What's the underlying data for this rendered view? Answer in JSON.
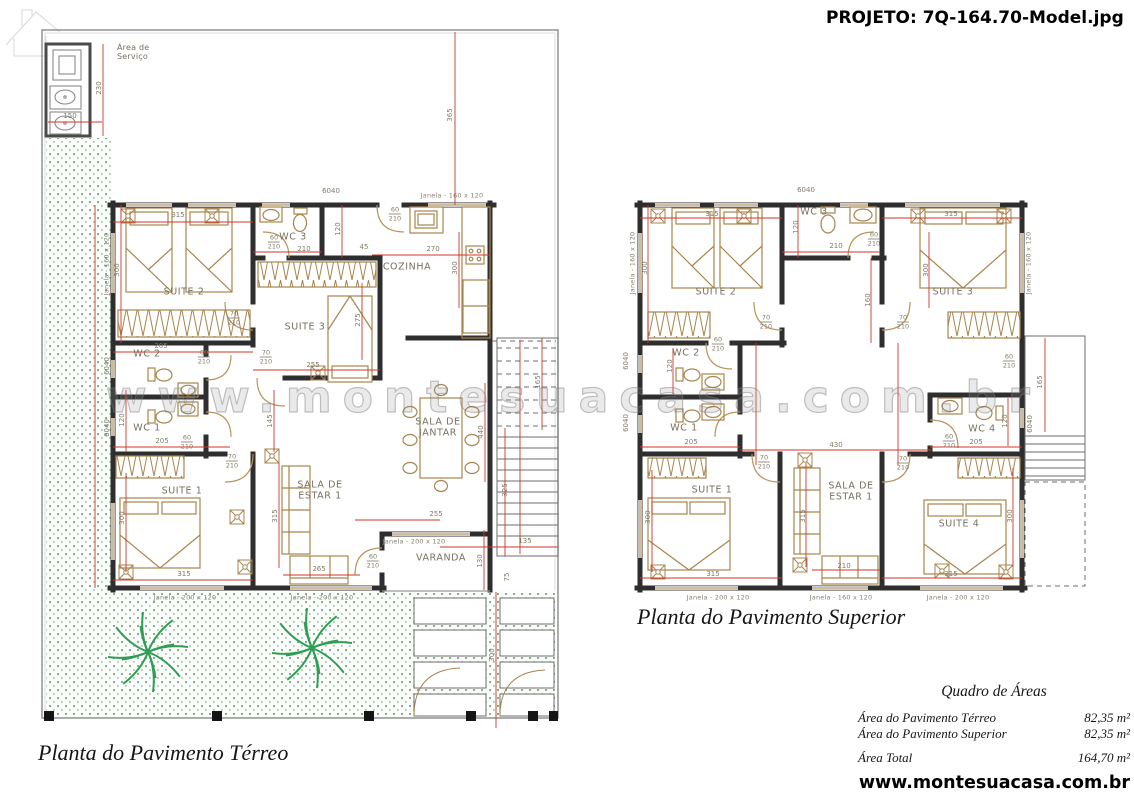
{
  "header": {
    "project_title": "PROJETO: 7Q-164.70-Model.jpg"
  },
  "watermark": {
    "text": "www.montesuacasa.com.br"
  },
  "footer": {
    "url": "www.montesuacasa.com.br"
  },
  "captions": {
    "terreo": "Planta do Pavimento Térreo",
    "superior": "Planta do Pavimento Superior"
  },
  "area_table": {
    "title": "Quadro de Áreas",
    "rows": [
      {
        "label": "Área do Pavimento Térreo",
        "value": "82,35 m²"
      },
      {
        "label": "Área do Pavimento Superior",
        "value": "82,35 m²"
      },
      {
        "label": "Área Total",
        "value": "164,70 m²",
        "total": true
      }
    ]
  },
  "colors": {
    "dimension_line": "#d13427",
    "wall": "#2e2e2e",
    "furniture": "#a8854e",
    "garden": "#79b97f"
  },
  "annotations": [
    {
      "t": "Área de\nServiço",
      "x": 117,
      "y": 53,
      "cls": "room sm"
    },
    {
      "t": "SUITE 2",
      "x": 184,
      "y": 293,
      "cls": "room"
    },
    {
      "t": "WC 3",
      "x": 293,
      "y": 238,
      "cls": "room"
    },
    {
      "t": "SUITE 3",
      "x": 305,
      "y": 328,
      "cls": "room"
    },
    {
      "t": "COZINHA",
      "x": 407,
      "y": 268,
      "cls": "room"
    },
    {
      "t": "WC 2",
      "x": 147,
      "y": 355,
      "cls": "room"
    },
    {
      "t": "WC 1",
      "x": 147,
      "y": 429,
      "cls": "room"
    },
    {
      "t": "SUITE 1",
      "x": 182,
      "y": 492,
      "cls": "room"
    },
    {
      "t": "SALA DE\nESTAR 1",
      "x": 320,
      "y": 491,
      "cls": "room"
    },
    {
      "t": "SALA DE\nJANTAR",
      "x": 438,
      "y": 428,
      "cls": "room"
    },
    {
      "t": "VARANDA",
      "x": 441,
      "y": 559,
      "cls": "room"
    },
    {
      "t": "SUITE 2",
      "x": 716,
      "y": 293,
      "cls": "room"
    },
    {
      "t": "WC 3",
      "x": 814,
      "y": 213,
      "cls": "room"
    },
    {
      "t": "SUITE 3",
      "x": 953,
      "y": 293,
      "cls": "room"
    },
    {
      "t": "WC 2",
      "x": 686,
      "y": 354,
      "cls": "room"
    },
    {
      "t": "WC 1",
      "x": 684,
      "y": 429,
      "cls": "room"
    },
    {
      "t": "WC 4",
      "x": 982,
      "y": 430,
      "cls": "room"
    },
    {
      "t": "SUITE 1",
      "x": 712,
      "y": 491,
      "cls": "room"
    },
    {
      "t": "SALA DE\nESTAR 1",
      "x": 851,
      "y": 492,
      "cls": "room"
    },
    {
      "t": "SUITE 4",
      "x": 959,
      "y": 525,
      "cls": "room"
    },
    {
      "t": "230",
      "x": 100,
      "y": 88,
      "cls": "dim",
      "r": 1
    },
    {
      "t": "150",
      "x": 70,
      "y": 117,
      "cls": "dim"
    },
    {
      "t": "365",
      "x": 451,
      "y": 115,
      "cls": "dim",
      "r": 1
    },
    {
      "t": "6040",
      "x": 331,
      "y": 192,
      "cls": "dim"
    },
    {
      "t": "315",
      "x": 178,
      "y": 216,
      "cls": "dim"
    },
    {
      "t": "300",
      "x": 118,
      "y": 270,
      "cls": "dim",
      "r": 1
    },
    {
      "t": "120",
      "x": 339,
      "y": 229,
      "cls": "dim",
      "r": 1
    },
    {
      "t": "210",
      "x": 304,
      "y": 250,
      "cls": "dim"
    },
    {
      "t": "45",
      "x": 364,
      "y": 248,
      "cls": "dim"
    },
    {
      "t": "270",
      "x": 433,
      "y": 250,
      "cls": "dim"
    },
    {
      "t": "300",
      "x": 456,
      "y": 268,
      "cls": "dim",
      "r": 1
    },
    {
      "t": "275",
      "x": 359,
      "y": 320,
      "cls": "dim",
      "r": 1
    },
    {
      "t": "205",
      "x": 161,
      "y": 347,
      "cls": "dim"
    },
    {
      "t": "255",
      "x": 313,
      "y": 366,
      "cls": "dim"
    },
    {
      "t": "120",
      "x": 123,
      "y": 420,
      "cls": "dim",
      "r": 1
    },
    {
      "t": "205",
      "x": 162,
      "y": 442,
      "cls": "dim"
    },
    {
      "t": "145",
      "x": 271,
      "y": 421,
      "cls": "dim",
      "r": 1
    },
    {
      "t": "300",
      "x": 123,
      "y": 518,
      "cls": "dim",
      "r": 1
    },
    {
      "t": "315",
      "x": 184,
      "y": 575,
      "cls": "dim"
    },
    {
      "t": "315",
      "x": 276,
      "y": 516,
      "cls": "dim",
      "r": 1
    },
    {
      "t": "265",
      "x": 319,
      "y": 570,
      "cls": "dim"
    },
    {
      "t": "440",
      "x": 482,
      "y": 432,
      "cls": "dim",
      "r": 1
    },
    {
      "t": "255",
      "x": 436,
      "y": 515,
      "cls": "dim"
    },
    {
      "t": "135",
      "x": 525,
      "y": 542,
      "cls": "dim"
    },
    {
      "t": "130",
      "x": 481,
      "y": 561,
      "cls": "dim",
      "r": 1
    },
    {
      "t": "325",
      "x": 506,
      "y": 490,
      "cls": "dim",
      "r": 1
    },
    {
      "t": "165",
      "x": 539,
      "y": 382,
      "cls": "dim",
      "r": 1
    },
    {
      "t": "300",
      "x": 493,
      "y": 655,
      "cls": "dim",
      "r": 1
    },
    {
      "t": "75",
      "x": 508,
      "y": 577,
      "cls": "dim",
      "r": 1
    },
    {
      "t": "6040",
      "x": 108,
      "y": 366,
      "cls": "dim",
      "r": 1
    },
    {
      "t": "6040",
      "x": 108,
      "y": 428,
      "cls": "dim",
      "r": 1
    },
    {
      "t": "60/210",
      "x": 274,
      "y": 242,
      "cls": "frac"
    },
    {
      "t": "60/210",
      "x": 395,
      "y": 214,
      "cls": "frac"
    },
    {
      "t": "70/210",
      "x": 234,
      "y": 318,
      "cls": "frac"
    },
    {
      "t": "70/210",
      "x": 266,
      "y": 357,
      "cls": "frac"
    },
    {
      "t": "60/210",
      "x": 204,
      "y": 357,
      "cls": "frac"
    },
    {
      "t": "60/210",
      "x": 187,
      "y": 442,
      "cls": "frac"
    },
    {
      "t": "70/210",
      "x": 232,
      "y": 461,
      "cls": "frac"
    },
    {
      "t": "60/210",
      "x": 373,
      "y": 561,
      "cls": "frac"
    },
    {
      "t": "Janela - 160 x 120",
      "x": 452,
      "y": 196,
      "cls": "win"
    },
    {
      "t": "Janela - 200 x 120",
      "x": 185,
      "y": 598,
      "cls": "win"
    },
    {
      "t": "Janela - 200 x 120",
      "x": 322,
      "y": 598,
      "cls": "win"
    },
    {
      "t": "Janela - 200 x 120",
      "x": 414,
      "y": 542,
      "cls": "win"
    },
    {
      "t": "Janela - 160 x 120",
      "x": 107,
      "y": 264,
      "cls": "win",
      "r": 1
    },
    {
      "t": "6040",
      "x": 806,
      "y": 191,
      "cls": "dim"
    },
    {
      "t": "315",
      "x": 712,
      "y": 215,
      "cls": "dim"
    },
    {
      "t": "300",
      "x": 646,
      "y": 268,
      "cls": "dim",
      "r": 1
    },
    {
      "t": "120",
      "x": 797,
      "y": 227,
      "cls": "dim",
      "r": 1
    },
    {
      "t": "210",
      "x": 836,
      "y": 247,
      "cls": "dim"
    },
    {
      "t": "315",
      "x": 951,
      "y": 215,
      "cls": "dim"
    },
    {
      "t": "300",
      "x": 927,
      "y": 270,
      "cls": "dim",
      "r": 1
    },
    {
      "t": "160",
      "x": 869,
      "y": 300,
      "cls": "dim",
      "r": 1
    },
    {
      "t": "120",
      "x": 671,
      "y": 366,
      "cls": "dim",
      "r": 1
    },
    {
      "t": "205",
      "x": 691,
      "y": 443,
      "cls": "dim"
    },
    {
      "t": "430",
      "x": 836,
      "y": 446,
      "cls": "dim"
    },
    {
      "t": "205",
      "x": 976,
      "y": 443,
      "cls": "dim"
    },
    {
      "t": "120",
      "x": 1006,
      "y": 421,
      "cls": "dim",
      "r": 1
    },
    {
      "t": "300",
      "x": 649,
      "y": 517,
      "cls": "dim",
      "r": 1
    },
    {
      "t": "315",
      "x": 713,
      "y": 575,
      "cls": "dim"
    },
    {
      "t": "315",
      "x": 804,
      "y": 516,
      "cls": "dim",
      "r": 1
    },
    {
      "t": "210",
      "x": 844,
      "y": 567,
      "cls": "dim"
    },
    {
      "t": "315",
      "x": 951,
      "y": 575,
      "cls": "dim"
    },
    {
      "t": "300",
      "x": 1011,
      "y": 516,
      "cls": "dim",
      "r": 1
    },
    {
      "t": "165",
      "x": 1041,
      "y": 382,
      "cls": "dim",
      "r": 1
    },
    {
      "t": "6040",
      "x": 1031,
      "y": 424,
      "cls": "dim",
      "r": 1
    },
    {
      "t": "6040",
      "x": 627,
      "y": 361,
      "cls": "dim",
      "r": 1
    },
    {
      "t": "6040",
      "x": 627,
      "y": 423,
      "cls": "dim",
      "r": 1
    },
    {
      "t": "60/210",
      "x": 874,
      "y": 239,
      "cls": "frac"
    },
    {
      "t": "70/210",
      "x": 766,
      "y": 322,
      "cls": "frac"
    },
    {
      "t": "70/210",
      "x": 903,
      "y": 322,
      "cls": "frac"
    },
    {
      "t": "60/210",
      "x": 718,
      "y": 344,
      "cls": "frac"
    },
    {
      "t": "60/210",
      "x": 949,
      "y": 441,
      "cls": "frac"
    },
    {
      "t": "70/210",
      "x": 764,
      "y": 462,
      "cls": "frac"
    },
    {
      "t": "70/210",
      "x": 903,
      "y": 463,
      "cls": "frac"
    },
    {
      "t": "60/210",
      "x": 1009,
      "y": 361,
      "cls": "frac"
    },
    {
      "t": "Janela - 160 x 120",
      "x": 633,
      "y": 263,
      "cls": "win",
      "r": 1
    },
    {
      "t": "Janela - 160 x 120",
      "x": 1029,
      "y": 263,
      "cls": "win",
      "r": 1
    },
    {
      "t": "Janela - 200 x 120",
      "x": 718,
      "y": 598,
      "cls": "win"
    },
    {
      "t": "Janela - 160 x 120",
      "x": 841,
      "y": 598,
      "cls": "win"
    },
    {
      "t": "Janela - 200 x 120",
      "x": 958,
      "y": 598,
      "cls": "win"
    }
  ]
}
